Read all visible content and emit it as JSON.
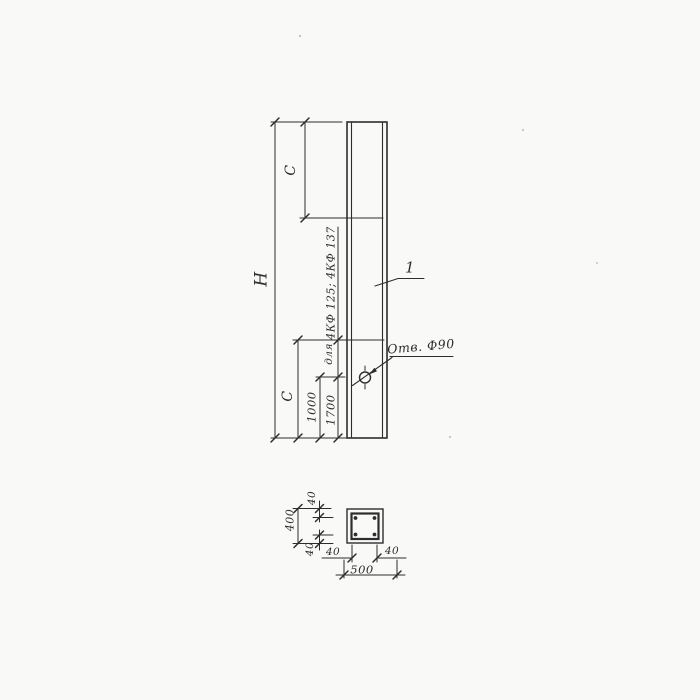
{
  "main_view": {
    "dim_H": "Н",
    "dim_C_top": "С",
    "dim_C_bottom": "С",
    "dim_1000": "1000",
    "dim_1700": "1700",
    "note_word_for": "для",
    "note_types": "4КФ 125; 4КФ 137",
    "hole_note": "Отв. Ф90",
    "item_number": "1"
  },
  "section_view": {
    "overall_width": "500",
    "overall_height": "400",
    "offset_top": "40",
    "offset_bottom": "40",
    "offset_left": "40",
    "offset_right": "40"
  },
  "colors": {
    "ink": "#2d2d2d",
    "paper": "#f9f9f7"
  }
}
